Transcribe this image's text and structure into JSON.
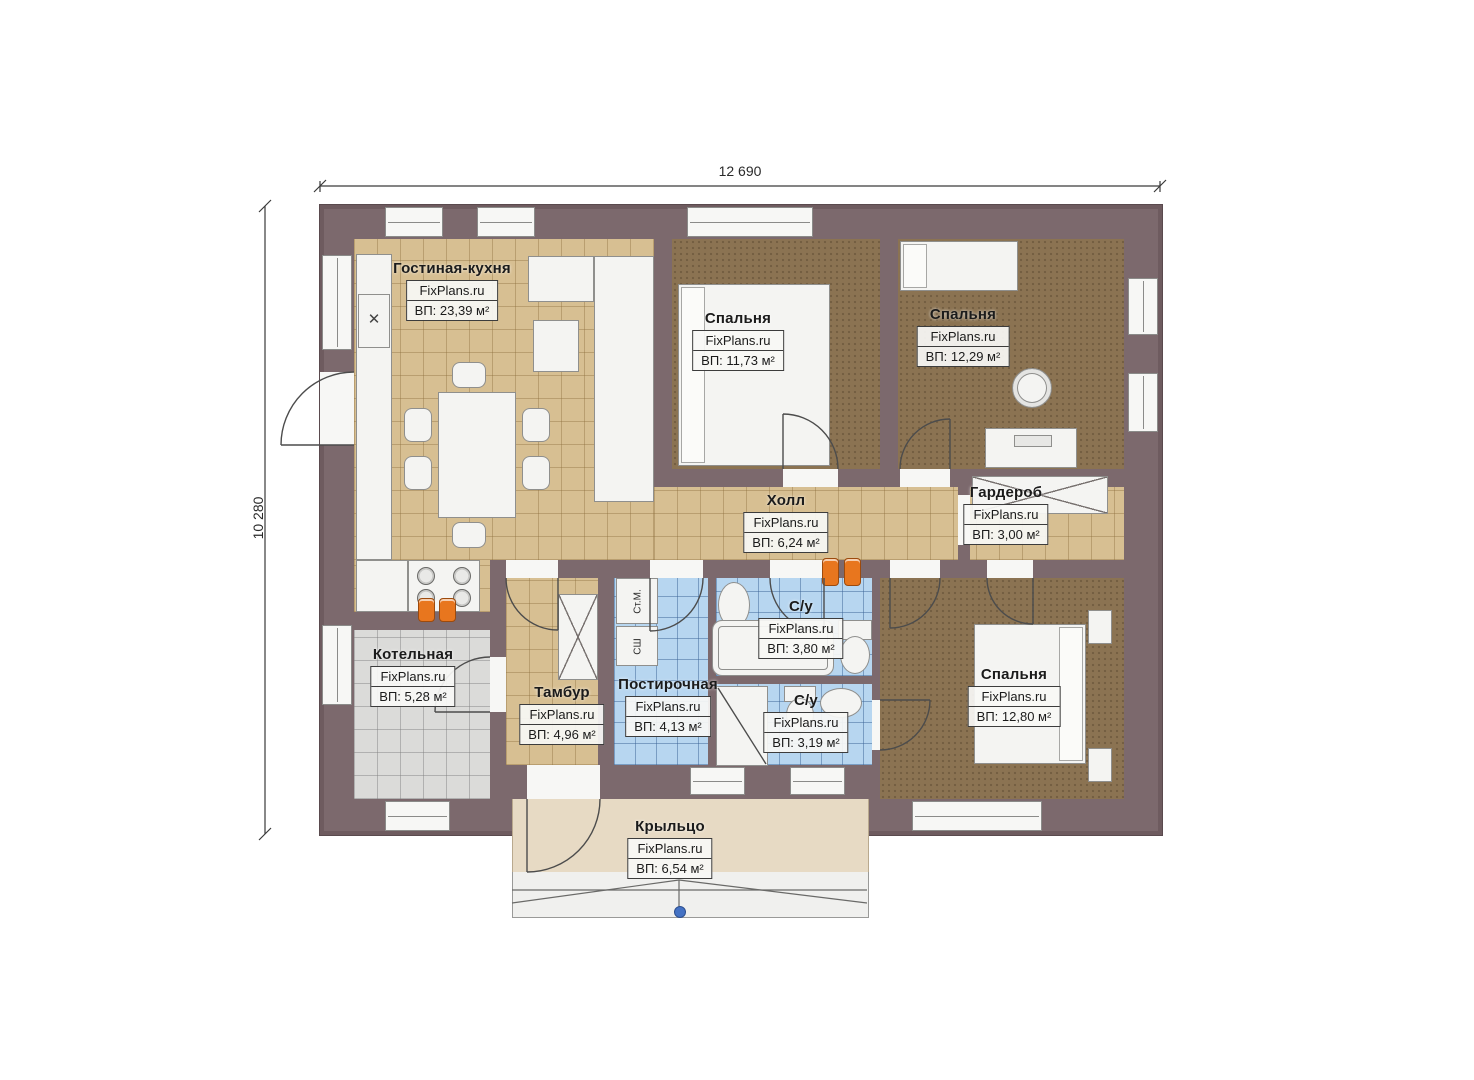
{
  "plan": {
    "type": "floor-plan",
    "dimensions": {
      "width_label": "12 690",
      "height_label": "10 280"
    },
    "watermark": "FixPlans.ru",
    "rooms": [
      {
        "id": "living",
        "title": "Гостиная-кухня",
        "site": "FixPlans.ru",
        "area": "ВП: 23,39 м²"
      },
      {
        "id": "bedroom1",
        "title": "Спальня",
        "site": "FixPlans.ru",
        "area": "ВП: 11,73 м²"
      },
      {
        "id": "bedroom2",
        "title": "Спальня",
        "site": "FixPlans.ru",
        "area": "ВП: 12,29 м²"
      },
      {
        "id": "hall",
        "title": "Холл",
        "site": "FixPlans.ru",
        "area": "ВП: 6,24 м²"
      },
      {
        "id": "wardrobe",
        "title": "Гардероб",
        "site": "FixPlans.ru",
        "area": "ВП: 3,00 м²"
      },
      {
        "id": "boiler",
        "title": "Котельная",
        "site": "FixPlans.ru",
        "area": "ВП: 5,28 м²"
      },
      {
        "id": "tambour",
        "title": "Тамбур",
        "site": "FixPlans.ru",
        "area": "ВП: 4,96 м²"
      },
      {
        "id": "laundry",
        "title": "Постирочная",
        "site": "FixPlans.ru",
        "area": "ВП: 4,13 м²"
      },
      {
        "id": "bath1",
        "title": "С/у",
        "site": "FixPlans.ru",
        "area": "ВП: 3,80 м²"
      },
      {
        "id": "bath2",
        "title": "С/у",
        "site": "FixPlans.ru",
        "area": "ВП: 3,19 м²"
      },
      {
        "id": "bedroom3",
        "title": "Спальня",
        "site": "FixPlans.ru",
        "area": "ВП: 12,80 м²"
      },
      {
        "id": "porch",
        "title": "Крыльцо",
        "site": "FixPlans.ru",
        "area": "ВП: 6,54 м²"
      }
    ],
    "appliances": {
      "washer": "Ст.М.",
      "dryer": "СШ"
    },
    "colors": {
      "wall": "#7c696d",
      "floor_tile_tan": "#d7bf92",
      "floor_carpet_brown": "#8b7352",
      "floor_tile_blue": "#b7d6f0",
      "floor_tile_gray": "#dbdbd9",
      "porch": "#e7dac4",
      "radiator_orange": "#e8761e",
      "marker_blue": "#4472c4"
    }
  }
}
